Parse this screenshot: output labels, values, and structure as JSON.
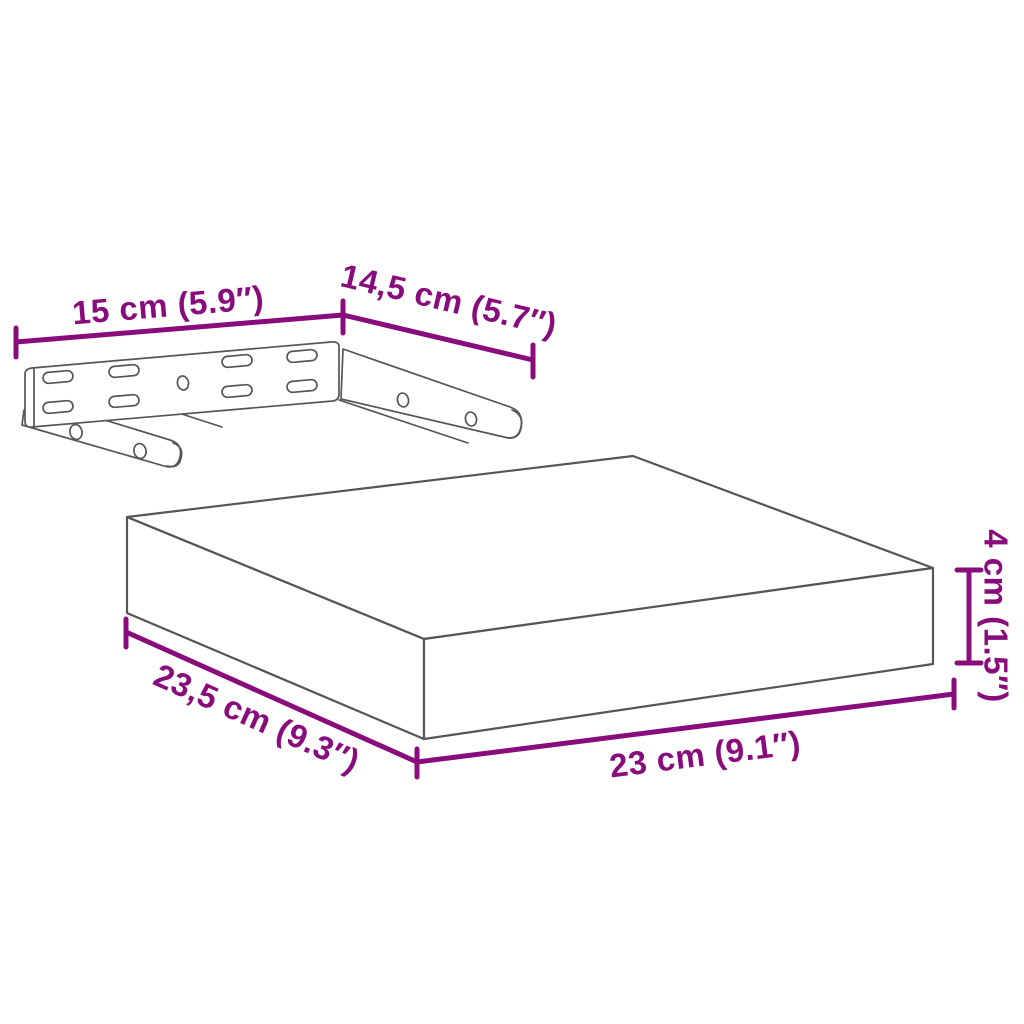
{
  "diagram": {
    "labels": {
      "bracket_width": "15 cm (5.9″)",
      "bracket_depth": "14,5 cm (5.7″)",
      "shelf_depth": "23,5 cm (9.3″)",
      "shelf_width": "23 cm (9.1″)",
      "shelf_height": "4 cm (1.5″)"
    },
    "colors": {
      "dimension": "#880c7c",
      "outline": "#565656",
      "background": "#ffffff"
    }
  }
}
